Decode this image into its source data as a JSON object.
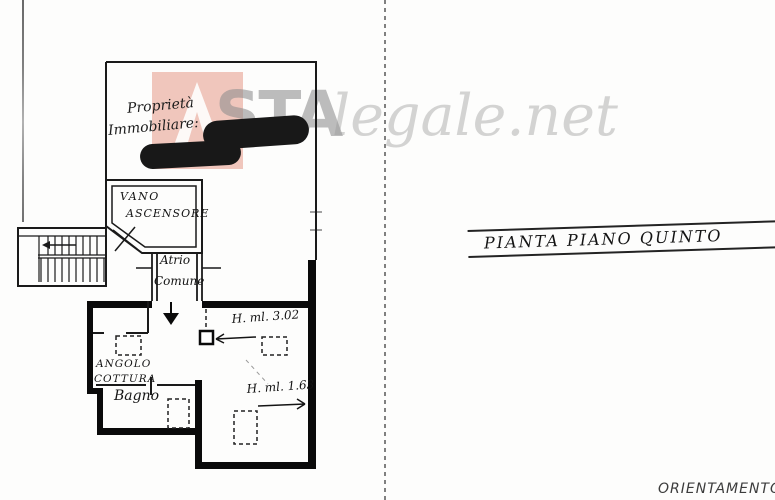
{
  "watermark": {
    "brand_bold": "STA",
    "brand_light": "legale.net",
    "logo_color": "#eebdb1"
  },
  "handwriting": {
    "line1": "Proprietà",
    "line2": "Immobiliare:"
  },
  "rooms": {
    "elevator": {
      "line1": "VANO",
      "line2": "ASCENSORE"
    },
    "atrium": {
      "line1": "Atrio",
      "line2": "Comune"
    },
    "kitchenette": {
      "line1": "ANGOLO",
      "line2": "COTTURA"
    },
    "bathroom": {
      "label": "Bagno"
    }
  },
  "measurements": {
    "ceiling_height_1": "H. ml. 3.02",
    "ceiling_height_2": "H. ml. 1.63"
  },
  "title_block": {
    "label": "PIANTA PIANO QUINTO"
  },
  "footer": {
    "orientation": "ORIENTAMENTO"
  }
}
